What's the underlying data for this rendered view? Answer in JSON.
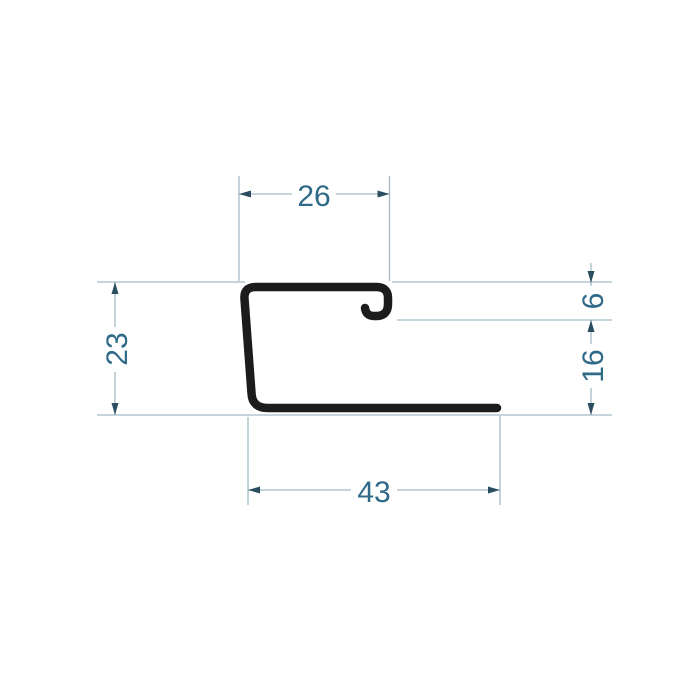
{
  "drawing": {
    "kind": "profile-cross-section-dimension-drawing",
    "dimensions": {
      "top_width": {
        "label": "26",
        "value": 26
      },
      "left_height": {
        "label": "23",
        "value": 23
      },
      "hook_height": {
        "label": "6",
        "value": 6
      },
      "lower_right_height": {
        "label": "16",
        "value": 16
      },
      "bottom_width": {
        "label": "43",
        "value": 43
      }
    },
    "colors": {
      "background": "#ffffff",
      "profile_stroke": "#1c1c1c",
      "dimension_line": "#a4bac6",
      "arrowhead": "#2b4d60",
      "dimension_text": "#2f6b88"
    }
  }
}
